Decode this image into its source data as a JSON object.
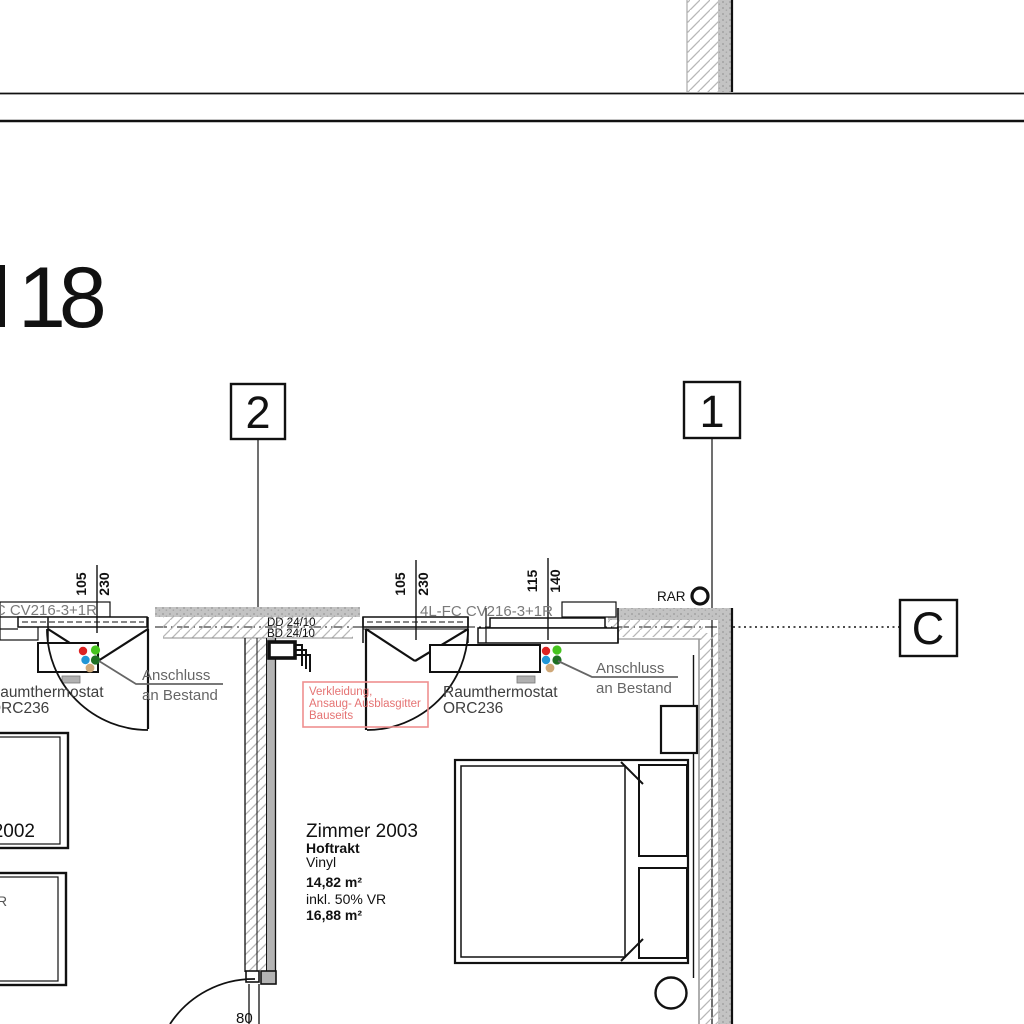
{
  "drawing": {
    "type": "architectural-floor-plan",
    "big_number": "18",
    "grid_markers": {
      "axis_2": "2",
      "axis_1": "1",
      "axis_c": "C"
    },
    "dimensions": {
      "left_opening_num": "105",
      "left_opening_den": "230",
      "mid_opening_num": "105",
      "mid_opening_den": "230",
      "right_opening_num": "115",
      "right_opening_den": "140",
      "bottom_door_width": "80"
    },
    "labels": {
      "rar": "RAR",
      "duct_top": "DD 24/10",
      "duct_bottom": "BD 24/10",
      "fancoil_left": "4L-FC CV216-3+1R",
      "fancoil_right": "4L-FC CV216-3+1R",
      "thermostat_left_line1": "Raumthermostat",
      "thermostat_left_line2": "ORC236",
      "thermostat_right_line1": "Raumthermostat",
      "thermostat_right_line2": "ORC236",
      "anschluss_left_line1": "Anschluss",
      "anschluss_left_line2": "an Bestand",
      "anschluss_right_line1": "Anschluss",
      "anschluss_right_line2": "an Bestand",
      "partial_r": "R"
    },
    "red_annotation": {
      "line1": "Verkleidung,",
      "line2": "Ansaug- Ausblasgitter",
      "line3": "Bauseits"
    },
    "room_right": {
      "name": "Zimmer 2003",
      "wing": "Hoftrakt",
      "floor": "Vinyl",
      "area": "14,82 m²",
      "incl": "inkl. 50% VR",
      "area_total": "16,88 m²"
    },
    "room_left": {
      "name": "Zimmer 2002"
    },
    "colors": {
      "line_black": "#111111",
      "wall_gray": "#c3c3c3",
      "hatch_gray": "#b8b8b8",
      "label_gray": "#6e6e6e",
      "thermo_gray": "#3f3f3f",
      "annotation_red": "#e57373",
      "annotation_red_border": "#ef8f8f",
      "dot_red": "#dd2222",
      "dot_green": "#46c41e",
      "dot_blue": "#2196d6",
      "dot_dark_green": "#1f6f22",
      "dot_tan": "#cfa878"
    }
  }
}
